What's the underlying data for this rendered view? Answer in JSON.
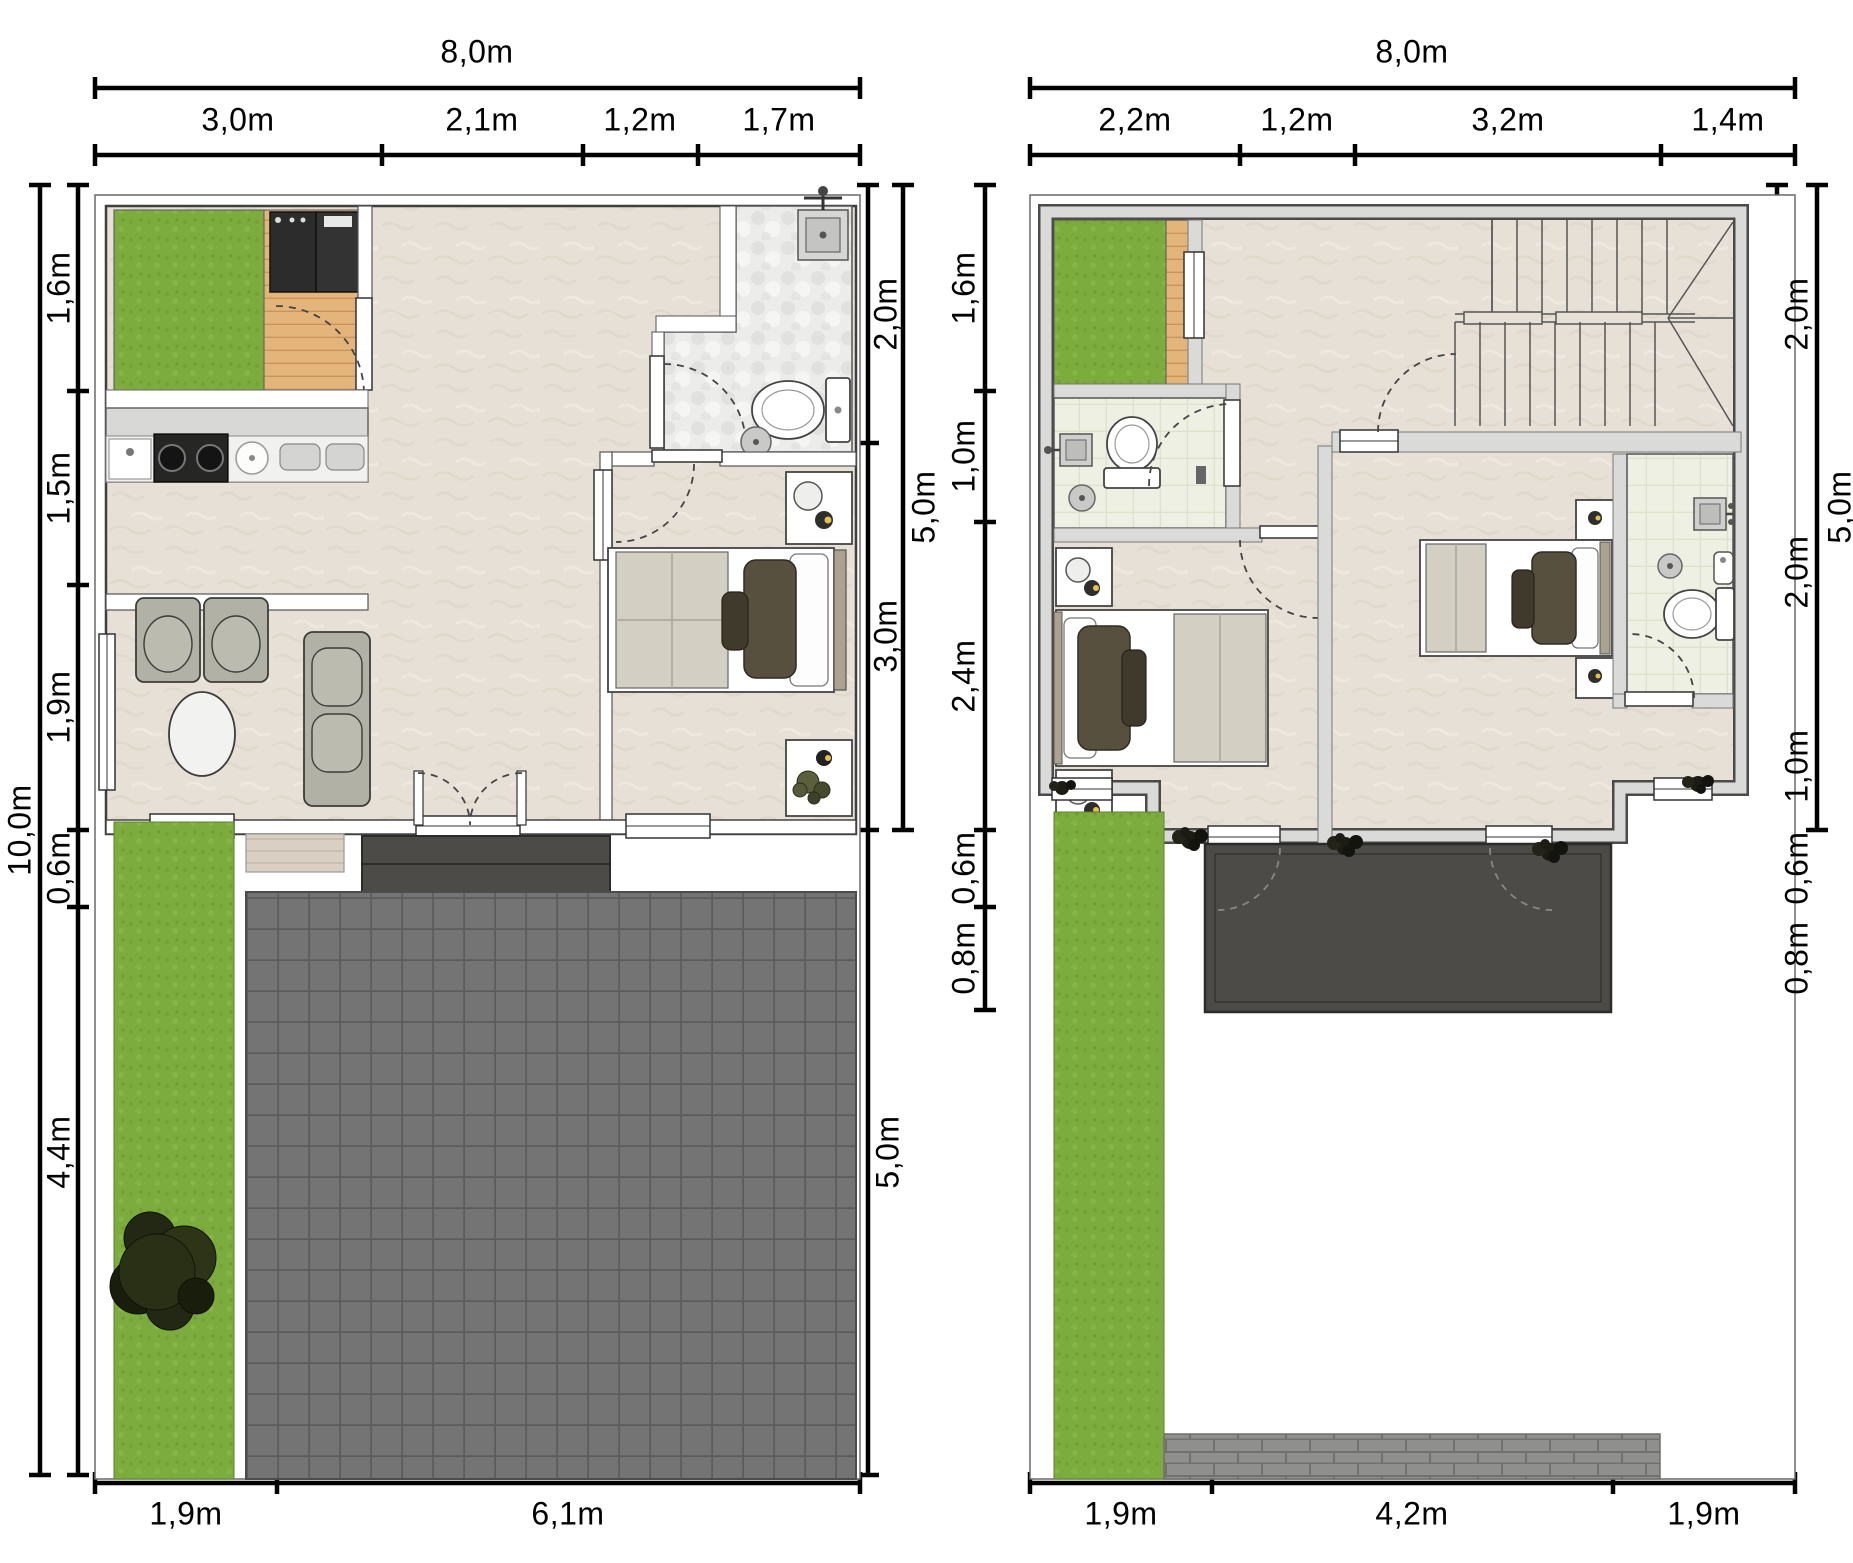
{
  "ground_floor": {
    "dims": {
      "top_total": "8,0m",
      "top_segments": [
        "3,0m",
        "2,1m",
        "1,2m",
        "1,7m"
      ],
      "left_total": "10,0m",
      "left_segments": [
        "1,6m",
        "1,5m",
        "1,9m",
        "0,6m",
        "4,4m"
      ],
      "right_segments": [
        "2,0m",
        "3,0m"
      ],
      "right_total_upper": "5,0m",
      "right_total_lower": "5,0m",
      "bottom_segments": [
        "1,9m",
        "6,1m"
      ]
    }
  },
  "upper_floor": {
    "dims": {
      "top_total": "8,0m",
      "top_segments": [
        "2,2m",
        "1,2m",
        "3,2m",
        "1,4m"
      ],
      "left_segments": [
        "1,6m",
        "1,0m",
        "2,4m",
        "0,6m",
        "0,8m"
      ],
      "right_segments": [
        "2,0m",
        "2,0m",
        "1,0m",
        "0,6m",
        "0,8m"
      ],
      "right_total": "5,0m",
      "bottom_segments": [
        "1,9m",
        "4,2m",
        "1,9m"
      ]
    }
  },
  "colors": {
    "dimension_lines": "#000000",
    "grass": "#7dac3e",
    "deck_wood": "#e4b57b",
    "floor_beige": "#e7e0d6",
    "bath_tile_gray": "#ececea",
    "bath_tile_green": "#edf0e3",
    "driveway_pavers": "#757474",
    "balcony_dark": "#4c4b47",
    "furniture_gray": "#b2b1a5"
  }
}
